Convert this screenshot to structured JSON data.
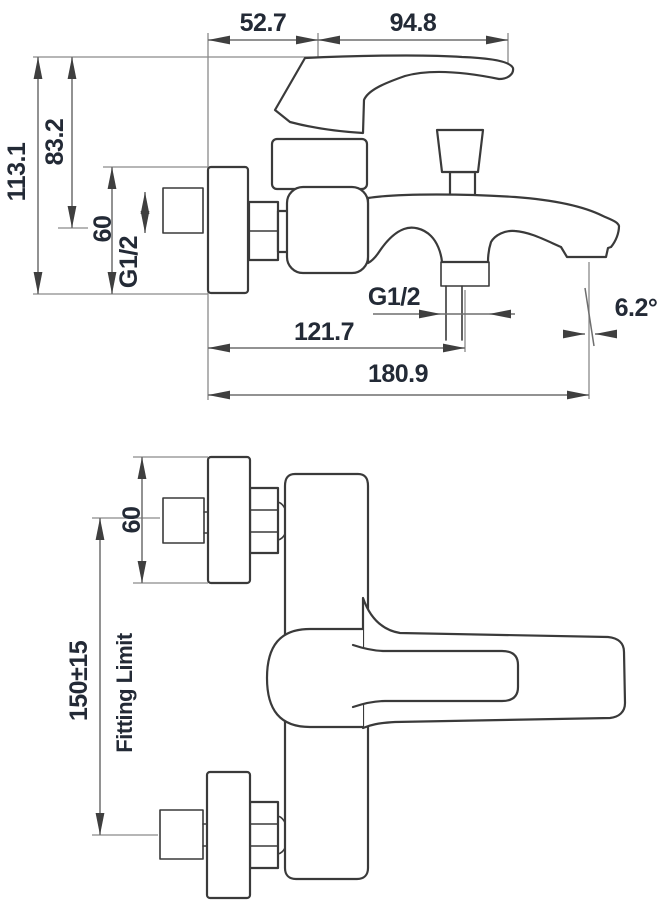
{
  "drawing": {
    "title": "bath-mixer-installation-dimensions",
    "side_view": {
      "handle_offset_from_wall": "52.7",
      "handle_length": "94.8",
      "total_height": "113.1",
      "upper_height": "83.2",
      "bracket_height": "60",
      "inlet_thread": "G1/2",
      "outlet_thread": "G1/2",
      "wall_to_outlet": "121.7",
      "total_projection": "180.9",
      "spout_angle": "6.2°"
    },
    "plan_view": {
      "bracket_height": "60",
      "fitting_distance": "150±15",
      "fitting_label": "Fitting Limit"
    },
    "colors": {
      "background": "#ffffff",
      "part_outline": "#3a3a3a",
      "dimension_line": "#6e6e6e",
      "label_text": "#232a36"
    }
  }
}
